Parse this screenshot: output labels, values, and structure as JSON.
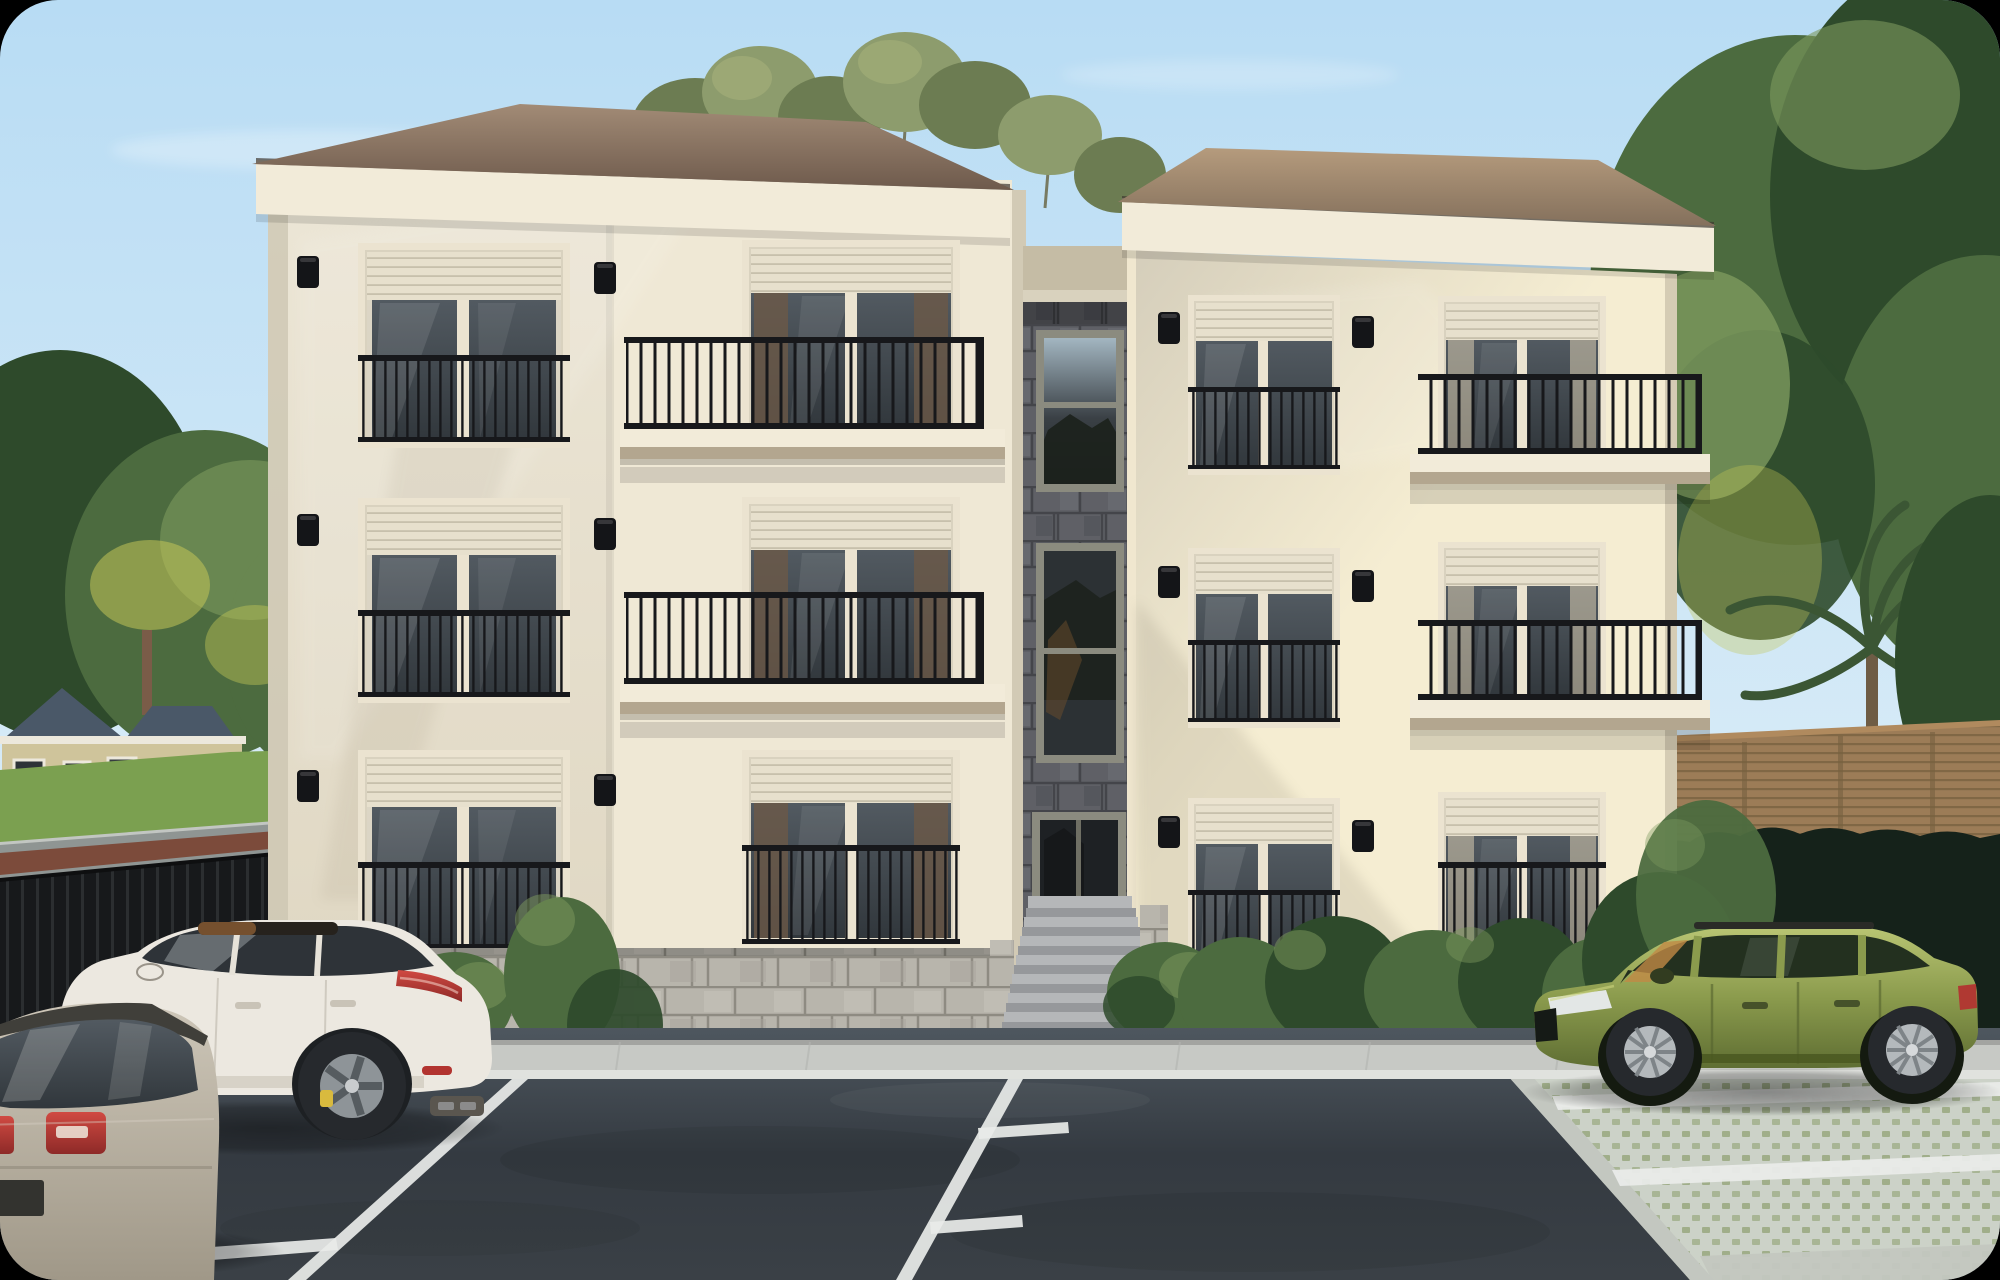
{
  "scene": {
    "subject": "Photorealistic dusk rendering of a three-story cream apartment building with balconies, stone stair tower, parking lot and three parked cars",
    "setting": "suburban street, clear pale-blue evening sky",
    "building": {
      "floors": 3,
      "left_wing": {
        "plain_windows": 3,
        "balcony_doors": 3,
        "balconies": 2,
        "juliet_railings": 4,
        "wall_lamps": 6
      },
      "stair_tower": {
        "cladding": "dark stone blocks",
        "tall_windows": 2,
        "entrance_door": 1,
        "entrance_steps": 7
      },
      "right_wing": {
        "juliet_windows": 3,
        "balcony_doors": 3,
        "corner_balconies": 2,
        "wall_lamps": 6
      },
      "roof": "brown shingle hip roof",
      "base": "rusticated light stone"
    },
    "vehicles": [
      {
        "name": "white-suv",
        "body": "cream-white SUV, panoramic roof, yellow brake calipers, red tail strip"
      },
      {
        "name": "silver-hatchback",
        "body": "silver-beige wagon seen from rear, red taillights"
      },
      {
        "name": "green-wagon",
        "body": "olive-green estate car parked on grass pavers, amber windshield reflection"
      }
    ],
    "environment": {
      "left": [
        "evergreen and yellow-green trees",
        "single family house with blue-gray roof",
        "lawn",
        "street with red bike lane",
        "black slat fence"
      ],
      "center": [
        "feathery eucalyptus crowns above the roof"
      ],
      "right": [
        "tall dense trees",
        "palm fronds",
        "horizontal-slat wood fence",
        "garden path",
        "dark hedge",
        "shrubs"
      ],
      "foreground": [
        "dark asphalt parking lot",
        "white stall markings with T-ends",
        "grass-paver parking pad with white lines",
        "concrete sidewalk"
      ]
    }
  },
  "palette": {
    "sky_top": "#b8dcf4",
    "sky_low": "#eaf4f9",
    "cloud": "#ffffff",
    "roof_l1": "#a28b76",
    "roof_l2": "#6e5a4c",
    "roof_r1": "#b59b7d",
    "roof_r2": "#84705c",
    "fascia": "#f2ebd9",
    "gutter": "#3f3831",
    "wall_l1": "#ece6d6",
    "wall_l2": "#e0d8c4",
    "wall_edge": "#cbc4b0",
    "wall_b": "#efe8d5",
    "wall_r1": "#f5edd2",
    "wall_r2": "#d5cebb",
    "wall_side": "#d5ccb4",
    "frame": "#ebe3d0",
    "shutter": "#e7e0cd",
    "shutter_line": "#c4bda9",
    "rail": "#17181b",
    "lamp": "#141518",
    "glass1": "#525a61",
    "glass2": "#31373c",
    "curtain": "#6b5947",
    "stone1": "#5f6066",
    "stone_joint": "#44454a",
    "recess": "#d9d2be",
    "tframe": "#8b8b7f",
    "base": "#b8b5ac",
    "base_joint": "#8e8b82",
    "sidewalk": "#c7c9c5",
    "curb": "#e0e2de",
    "asphalt1": "#4e575f",
    "asphalt2": "#343a41",
    "asphalt3": "#3a4046",
    "line": "#e9ebe9",
    "paver": "#ccd2c8",
    "paver_green": "#99a87f",
    "paver_curb": "#c3c7c0",
    "lawn": "#7ba050",
    "road": "#8f9593",
    "bike": "#7c4b3b",
    "fence": "#17191b",
    "slat": "#2e3132",
    "tree1": "#2e4a2b",
    "tree2": "#4c6b3f",
    "tree3": "#7d9a5e",
    "lime": "#c2c557",
    "feather1": "#8d9c6d",
    "feather2": "#6c7c52",
    "palm": "#3b5634",
    "wood1": "#9c7c57",
    "wood2": "#77603f",
    "hedge": "#15221a",
    "path": "#b9bcb6",
    "house_roof": "#4a5868",
    "house_wall": "#cfc49b",
    "house_trim": "#ece8dc",
    "suv": "#ece8e0",
    "suv_low": "#cfc9bc",
    "silver1": "#cdc6b8",
    "silver2": "#a09888",
    "green1": "#b9c573",
    "green2": "#8b9b4d",
    "green3": "#5f6e33",
    "red": "#b23430",
    "caliper": "#d9ba3e",
    "wheel": "#26292d",
    "rim": "#a8adb1",
    "steps1": "#b5b7b9",
    "steps2": "#96989b",
    "slab_u": "#b3a68f"
  }
}
